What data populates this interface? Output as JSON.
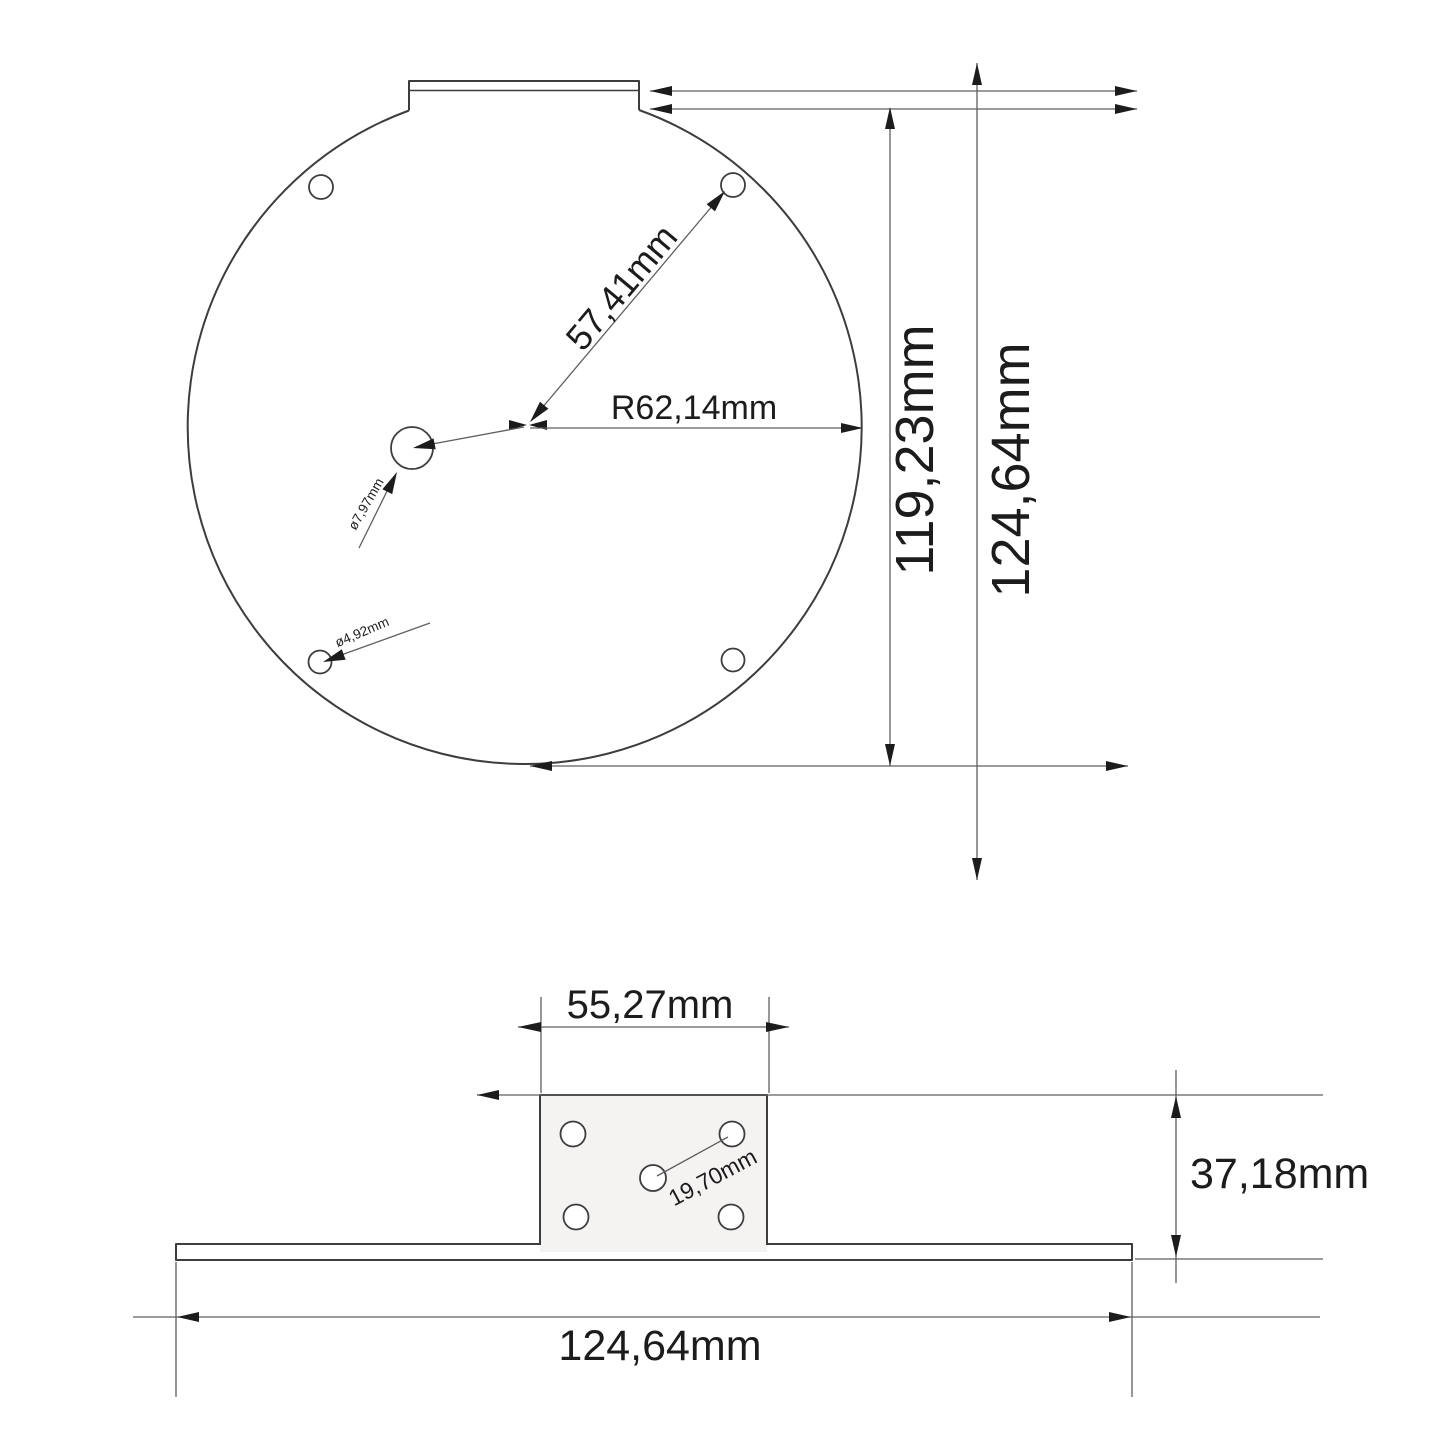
{
  "drawing": {
    "type": "technical-dimension-drawing",
    "colors": {
      "background": "#ffffff",
      "outline": "#3d3d3d",
      "dimension": "#5f5f5f",
      "text": "#1c1c1c",
      "block_fill": "#f5f2f2"
    }
  },
  "top_view": {
    "name": "plate-top-view",
    "dim_hole_diagonal": "57,41mm",
    "dim_radius": "R62,14mm",
    "dim_center_hole_diameter": "ø7,97mm",
    "dim_corner_hole_diameter": "ø4,92mm",
    "dim_inner_height": "119,23mm",
    "dim_total_height": "124,64mm"
  },
  "side_view": {
    "name": "bracket-side-view",
    "dim_block_width": "55,27mm",
    "dim_hole_spacing": "19,70mm",
    "dim_block_height": "37,18mm",
    "dim_total_width": "124,64mm"
  }
}
